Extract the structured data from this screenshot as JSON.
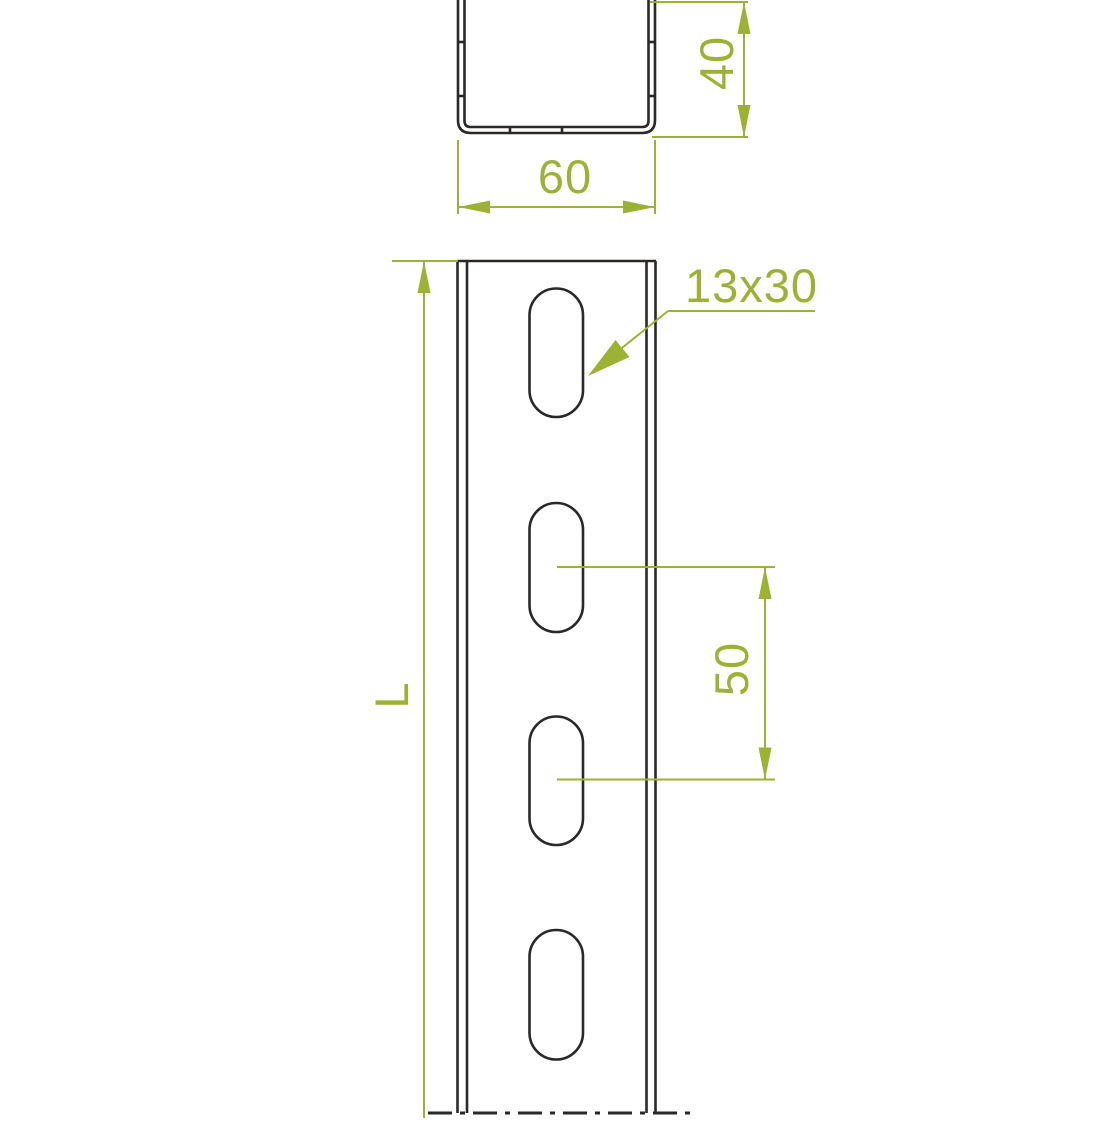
{
  "drawing": {
    "type": "technical-dimension-drawing",
    "background_color": "#ffffff",
    "outline_color": "#2b2927",
    "dimension_color": "#9cb233",
    "cross_section": {
      "width_label": "60",
      "height_label": "40"
    },
    "front_view": {
      "slot_size_label": "13x30",
      "slot_pitch_label": "50",
      "length_label": "L",
      "slot_count": 4
    }
  }
}
